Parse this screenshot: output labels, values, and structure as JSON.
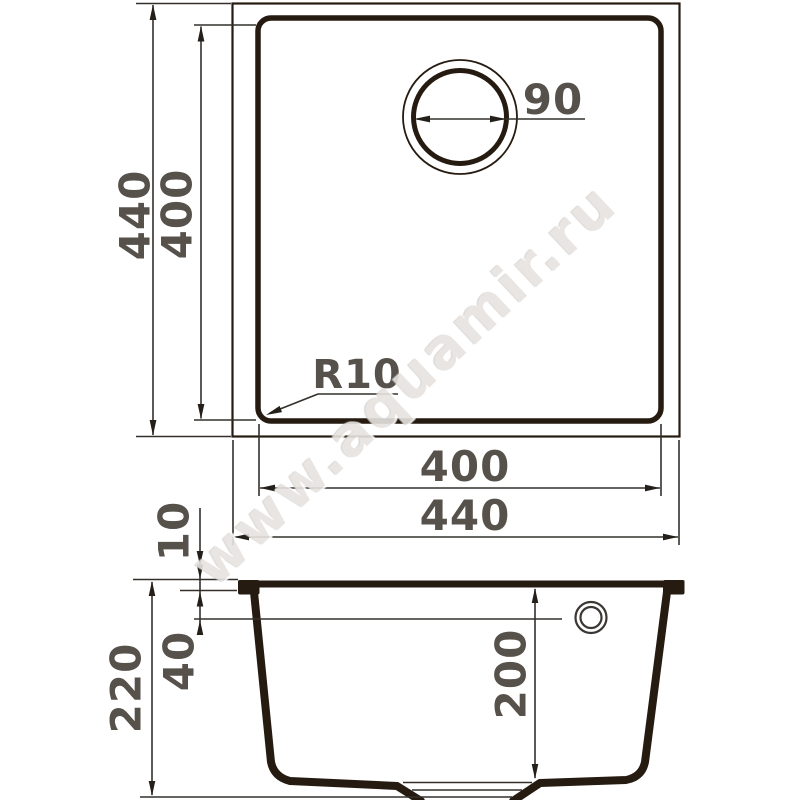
{
  "watermark": {
    "text": "www.aquamir.ru"
  },
  "palette": {
    "outline_ink": "#261b10",
    "thin_line": "#33302c",
    "dimension_text": "#57514b",
    "watermark_gray": "#e6e3e0",
    "background": "#ffffff"
  },
  "top_view": {
    "height_outer": "440",
    "height_inner": "400",
    "width_inner": "400",
    "width_outer": "440",
    "drain_diameter": "90",
    "corner_radius": "R10"
  },
  "section_view": {
    "rim_height": "10",
    "overflow_depth": "40",
    "overall_depth": "220",
    "bowl_depth": "200"
  }
}
